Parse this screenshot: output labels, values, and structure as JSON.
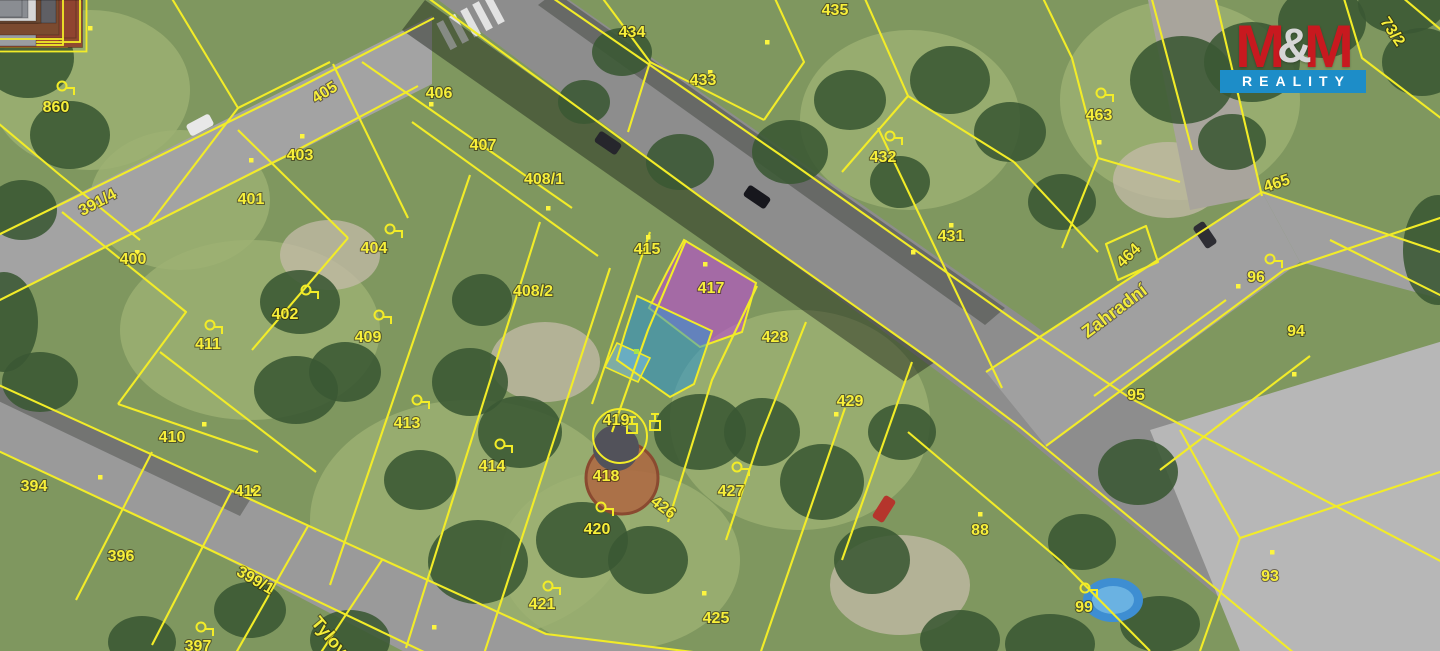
{
  "map": {
    "type": "cadastral-parcel-map-over-aerial-photo",
    "colors": {
      "cadastral_yellow": "#f2ec28",
      "label_yellow": "#f7ef3a",
      "highlight_purple": "#bb4fd0",
      "highlight_blue": "#2d95cf",
      "highlight_blue_light": "#7fc4e8"
    },
    "highlights": {
      "purple_parcel_number": "417",
      "blue_parcel_number": ""
    },
    "streets": [
      {
        "name": "Zahradní",
        "x": 1115,
        "y": 312,
        "r": -37
      },
      {
        "name": "Tylova",
        "x": 332,
        "y": 641,
        "r": 50
      }
    ],
    "parcels": [
      {
        "n": "860",
        "x": 56,
        "y": 108,
        "q": [
          62,
          86
        ]
      },
      {
        "n": "391/4",
        "x": 98,
        "y": 203,
        "r": -28
      },
      {
        "n": "405",
        "x": 325,
        "y": 93,
        "r": -32
      },
      {
        "n": "403",
        "x": 300,
        "y": 156
      },
      {
        "n": "401",
        "x": 251,
        "y": 200
      },
      {
        "n": "400",
        "x": 133,
        "y": 260
      },
      {
        "n": "402",
        "x": 285,
        "y": 315,
        "q": [
          306,
          290
        ]
      },
      {
        "n": "411",
        "x": 208,
        "y": 345,
        "q": [
          210,
          325
        ]
      },
      {
        "n": "404",
        "x": 374,
        "y": 249,
        "q": [
          390,
          229
        ]
      },
      {
        "n": "409",
        "x": 368,
        "y": 338,
        "q": [
          379,
          315
        ]
      },
      {
        "n": "406",
        "x": 439,
        "y": 94
      },
      {
        "n": "407",
        "x": 483,
        "y": 146
      },
      {
        "n": "408/1",
        "x": 544,
        "y": 180
      },
      {
        "n": "408/2",
        "x": 533,
        "y": 292
      },
      {
        "n": "410",
        "x": 172,
        "y": 438
      },
      {
        "n": "412",
        "x": 248,
        "y": 492
      },
      {
        "n": "394",
        "x": 34,
        "y": 487
      },
      {
        "n": "396",
        "x": 121,
        "y": 557
      },
      {
        "n": "397",
        "x": 198,
        "y": 647,
        "q": [
          201,
          627
        ]
      },
      {
        "n": "399/1",
        "x": 255,
        "y": 581,
        "r": 30
      },
      {
        "n": "413",
        "x": 407,
        "y": 424,
        "q": [
          417,
          400
        ]
      },
      {
        "n": "414",
        "x": 492,
        "y": 467,
        "q": [
          500,
          444
        ]
      },
      {
        "n": "415",
        "x": 647,
        "y": 250
      },
      {
        "n": "417",
        "x": 711,
        "y": 289
      },
      {
        "n": "428",
        "x": 775,
        "y": 338
      },
      {
        "n": "429",
        "x": 850,
        "y": 402
      },
      {
        "n": "419",
        "x": 616,
        "y": 421
      },
      {
        "n": "418",
        "x": 606,
        "y": 477
      },
      {
        "n": "420",
        "x": 597,
        "y": 530,
        "q": [
          601,
          507
        ]
      },
      {
        "n": "421",
        "x": 542,
        "y": 605,
        "q": [
          548,
          586
        ]
      },
      {
        "n": "425",
        "x": 716,
        "y": 619
      },
      {
        "n": "426",
        "x": 663,
        "y": 508,
        "r": 37
      },
      {
        "n": "427",
        "x": 731,
        "y": 492,
        "q": [
          737,
          467
        ]
      },
      {
        "n": "434",
        "x": 632,
        "y": 33
      },
      {
        "n": "433",
        "x": 703,
        "y": 81
      },
      {
        "n": "435",
        "x": 835,
        "y": 11
      },
      {
        "n": "432",
        "x": 883,
        "y": 158,
        "q": [
          890,
          136
        ]
      },
      {
        "n": "431",
        "x": 951,
        "y": 237
      },
      {
        "n": "463",
        "x": 1099,
        "y": 116,
        "q": [
          1101,
          93
        ]
      },
      {
        "n": "465",
        "x": 1277,
        "y": 184,
        "r": -18
      },
      {
        "n": "464",
        "x": 1129,
        "y": 256,
        "r": -44
      },
      {
        "n": "96",
        "x": 1256,
        "y": 278,
        "q": [
          1270,
          259
        ]
      },
      {
        "n": "94",
        "x": 1296,
        "y": 332
      },
      {
        "n": "95",
        "x": 1136,
        "y": 396
      },
      {
        "n": "73/2",
        "x": 1392,
        "y": 32,
        "r": 56
      },
      {
        "n": "88",
        "x": 980,
        "y": 531
      },
      {
        "n": "99",
        "x": 1084,
        "y": 608,
        "q": [
          1085,
          588
        ]
      },
      {
        "n": "93",
        "x": 1270,
        "y": 577
      }
    ],
    "icons": {
      "landuse_symbol": "circle-with-flag",
      "well_symbol": "square-with-post"
    }
  },
  "logo": {
    "m_left": "M",
    "amp": "&",
    "m_right": "M",
    "bottom": "REALITY",
    "color_red": "#c8191f",
    "color_blue": "#1d8dc8",
    "color_amp": "#d6d6d6"
  }
}
